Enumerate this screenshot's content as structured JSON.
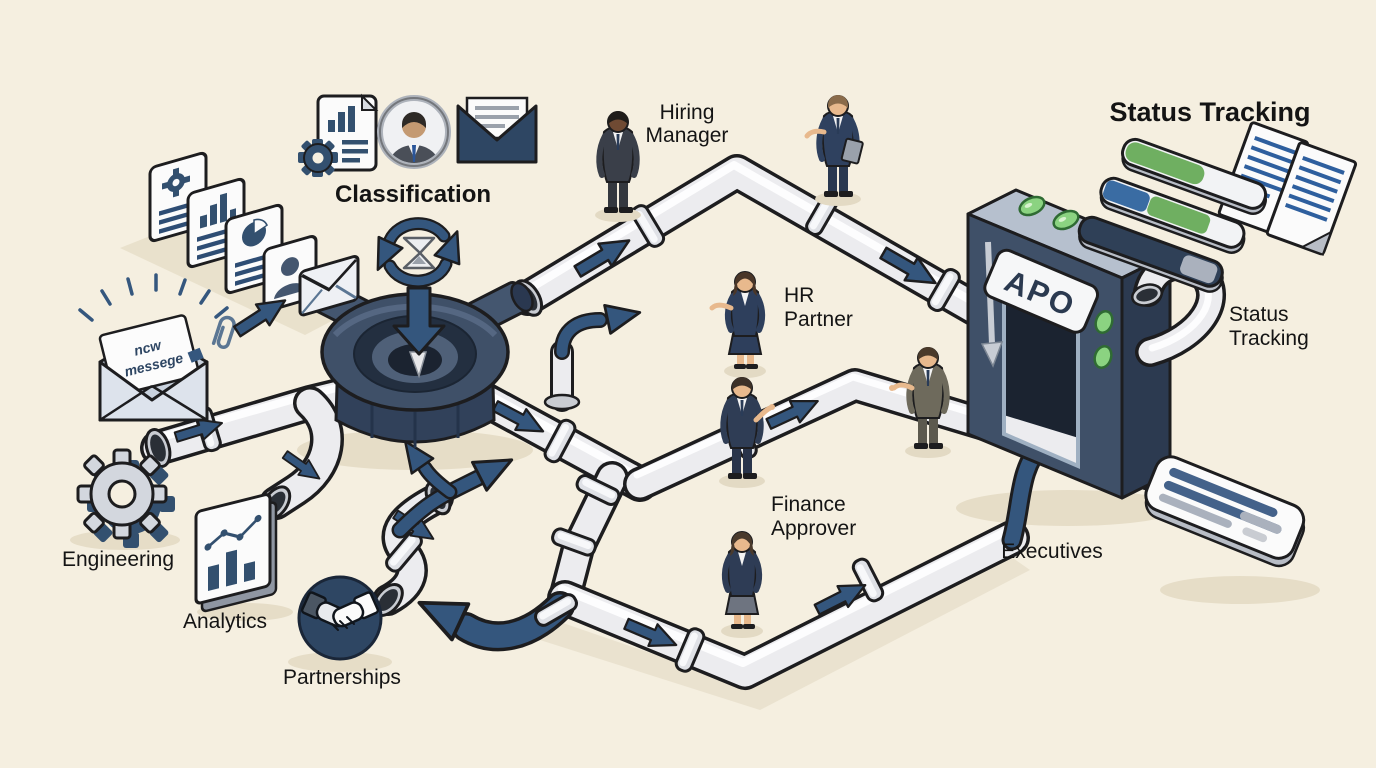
{
  "title": "Approval pipeline illustration",
  "colors": {
    "background": "#f5efe0",
    "shadow": "#e6ddc7",
    "outline": "#1d1d1f",
    "pipe_fill": "#ececef",
    "pipe_highlight": "#ffffff",
    "navy_arrow": "#34567d",
    "steel_front": "#3f5068",
    "steel_dark": "#2a3850",
    "steel_light": "#b6c0ce",
    "led_green": "#8bd381",
    "bar_green": "#6faf61",
    "bar_blue": "#3a6ca3",
    "bar_navy": "#2f4057",
    "bar_grey": "#aab1bd",
    "paper": "#fbfbfb",
    "text": "#141414"
  },
  "heading": {
    "status_tracking": "Status Tracking"
  },
  "labels": {
    "classification": "Classification",
    "hiring_manager": {
      "line1": "Hiring",
      "line2": "Manager"
    },
    "hr_partner": {
      "line1": "HR",
      "line2": "Partner"
    },
    "finance_approver": {
      "line1": "Finance",
      "line2": "Approver"
    },
    "executives": "Executives",
    "status_tracking_small": {
      "line1": "Status",
      "line2": "Tracking"
    },
    "engineering": "Engineering",
    "analytics": "Analytics",
    "partnerships": "Partnerships"
  },
  "gate": {
    "label": "APO",
    "top_led_count": 3,
    "side_led_count": 2
  },
  "new_message_note": {
    "line1": "ncw",
    "line2": "messege"
  },
  "icons": {
    "classification_group": [
      "report-document-icon",
      "person-avatar-icon",
      "open-envelope-icon"
    ],
    "document_stack": [
      "gear-document-icon",
      "bar-chart-document-icon",
      "pie-chart-document-icon",
      "person-card-icon",
      "envelope-icon"
    ],
    "intake": [
      "new-message-envelope-icon",
      "paperclip-icon",
      "rays-icon"
    ],
    "hub": [
      "recycle-arrows-icon",
      "hourglass-icon",
      "down-arrow-icon"
    ],
    "departments": [
      "gear-icon",
      "analytics-chart-icon",
      "handshake-icon"
    ],
    "tracking": [
      "progress-bar-icon",
      "document-lines-icon",
      "status-card-icon"
    ]
  },
  "status_tracking_bars": [
    {
      "segments": [
        {
          "color": "green",
          "fraction": 0.57
        }
      ]
    },
    {
      "segments": [
        {
          "color": "blue",
          "fraction": 0.32
        },
        {
          "color": "green",
          "fraction": 0.44
        }
      ]
    },
    {
      "segments": [
        {
          "color": "navy",
          "fraction": 0.73
        },
        {
          "color": "grey",
          "fraction": 0.25
        }
      ]
    }
  ]
}
